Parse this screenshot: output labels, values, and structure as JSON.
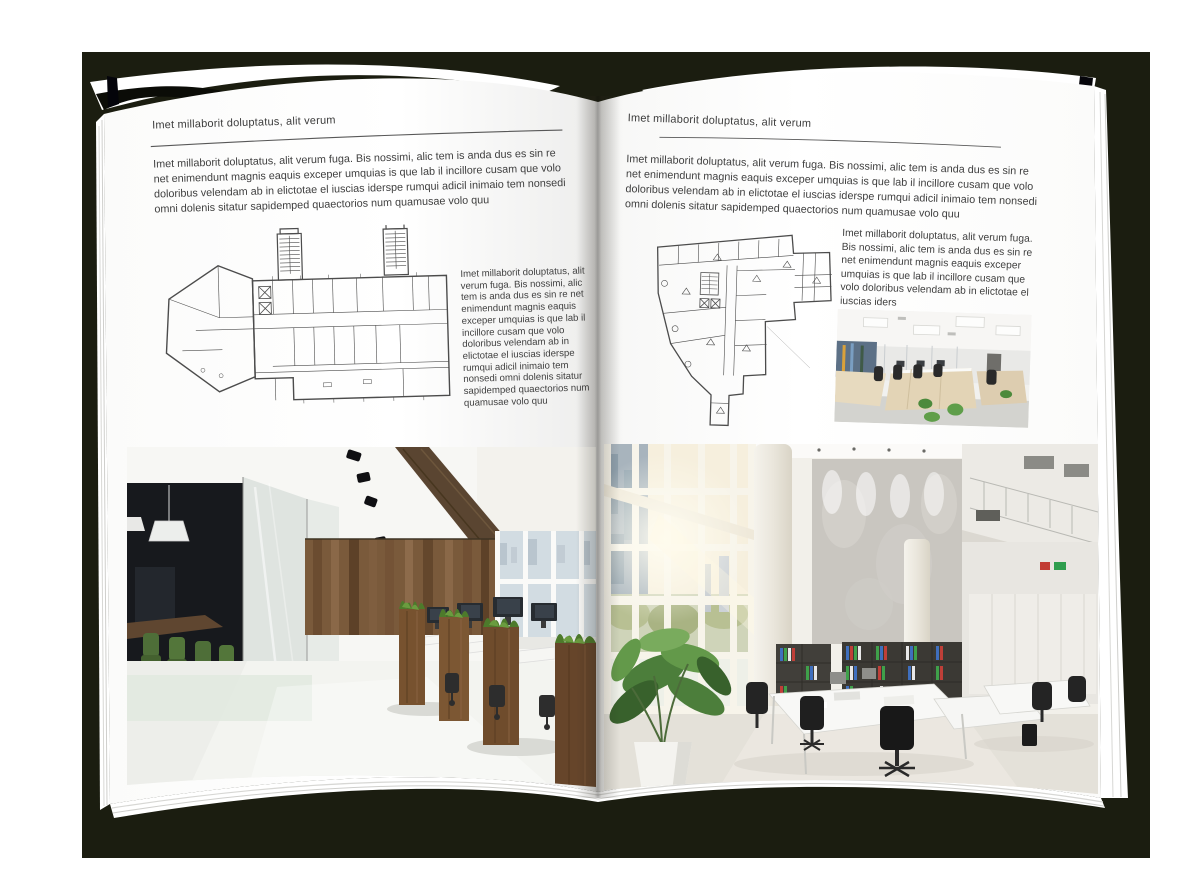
{
  "backdrop": {
    "color": "#1b1d10"
  },
  "book": {
    "page_color": "#ffffff",
    "edge_line_color": "#d7d7d4"
  },
  "left_page": {
    "kicker": "Imet millaborit doluptatus, alit verum",
    "intro": "Imet millaborit doluptatus, alit verum fuga. Bis nossimi, alic tem is anda dus es sin re net enimendunt magnis eaquis exceper umquias is que lab il incillore cusam que volo doloribus velendam ab in elictotae el iuscias iderspe rumqui adicil inimaio tem nonsedi omni dolenis sitatur sapidemped quaectorios num quamusae volo quu",
    "side_text": "Imet millaborit doluptatus, alit verum fuga. Bis nossimi, alic tem is anda dus es sin re net enimendunt magnis eaquis exceper umquias is que lab il incillore cusam que volo doloribus velendam ab in elictotae el iuscias iderspe rumqui adicil inimaio tem nonsedi omni dolenis sitatur sapidemped quaectorios num quamusae volo quu"
  },
  "right_page": {
    "kicker": "Imet millaborit doluptatus, alit verum",
    "intro": "Imet millaborit doluptatus, alit verum fuga. Bis nossimi, alic tem is anda dus es sin re net enimendunt magnis eaquis exceper umquias is que lab il incillore cusam que volo doloribus velendam ab in elictotae el iuscias iderspe rumqui adicil inimaio tem nonsedi omni dolenis sitatur sapidemped quaectorios num quamusae volo quu",
    "side_text": "Imet millaborit doluptatus, alit verum fuga. Bis nossimi, alic tem is anda dus es sin re net enimendunt magnis eaquis exceper umquias is que lab il incillore cusam que volo doloribus velendam ab in elictotae el iuscias iders"
  },
  "palette": {
    "backdrop": "#1b1d10",
    "page": "#ffffff",
    "body_text": "#3f3f3f",
    "rule": "#585858",
    "plan_ink": "#4c4c4c",
    "wood": "#6e4f33",
    "foliage_green": "#4c7a2c",
    "chair_green": "#4e6e38",
    "binder_blue": "#3f6fbe",
    "binder_green": "#3fa04a",
    "binder_red": "#bf3f38",
    "window_sky": "#d2dce2",
    "sunlight": "#fdf6e4"
  }
}
